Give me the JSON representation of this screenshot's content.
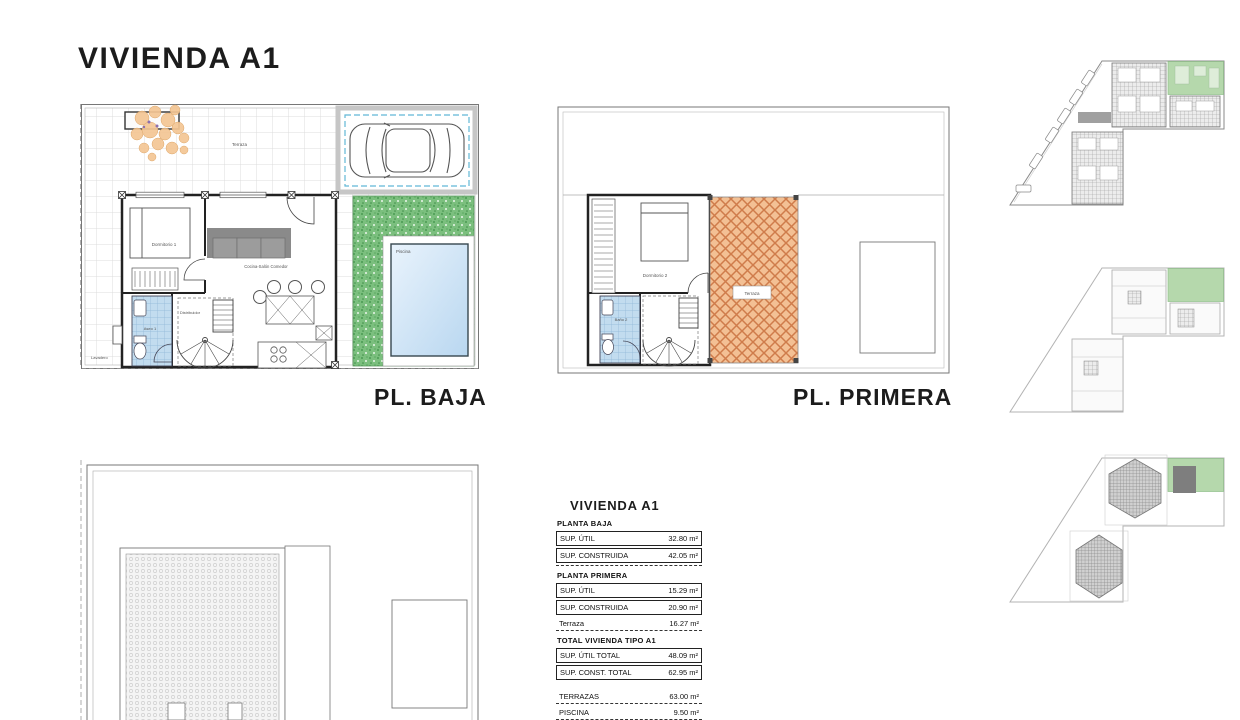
{
  "page": {
    "title": "VIVIENDA A1"
  },
  "floor_plans": {
    "ground": {
      "label": "PL. BAJA",
      "rooms": {
        "terrace": "Terraza",
        "bedroom": "Dormitorio 1",
        "living": "Cocina-Salón Comedor",
        "hall": "Distribuidor",
        "bath": "Aseo 1",
        "laundry": "Lavadero",
        "pool": "Piscina"
      }
    },
    "first": {
      "label": "PL. PRIMERA",
      "rooms": {
        "bedroom": "Dormitorio 2",
        "bath": "Baño 2",
        "terrace": "Terraza"
      }
    }
  },
  "area_table": {
    "title": "VIVIENDA A1",
    "sections": [
      {
        "heading": "PLANTA BAJA",
        "rows": [
          {
            "label": "SUP. ÚTIL",
            "value": "32.80 m²"
          },
          {
            "label": "SUP. CONSTRUIDA",
            "value": "42.05 m²"
          }
        ]
      },
      {
        "heading": "PLANTA PRIMERA",
        "rows": [
          {
            "label": "SUP. ÚTIL",
            "value": "15.29 m²"
          },
          {
            "label": "SUP. CONSTRUIDA",
            "value": "20.90 m²"
          },
          {
            "label": "Terraza",
            "value": "16.27 m²"
          }
        ]
      },
      {
        "heading": "TOTAL VIVIENDA TIPO A1",
        "rows": [
          {
            "label": "SUP. ÚTIL TOTAL",
            "value": "48.09 m²"
          },
          {
            "label": "SUP. CONST. TOTAL",
            "value": "62.95 m²"
          }
        ]
      },
      {
        "heading": "",
        "rows": [
          {
            "label": "TERRAZAS",
            "value": "63.00 m²"
          },
          {
            "label": "PISCINA",
            "value": "9.50 m²"
          }
        ]
      }
    ]
  },
  "colors": {
    "highlight_green": "#b5d8ac",
    "terrace_orange": "#f3c094",
    "garden_green": "#7bbf7e",
    "pool_blue": "#cfe3f5",
    "parking_dash_blue": "#62b8d6"
  }
}
